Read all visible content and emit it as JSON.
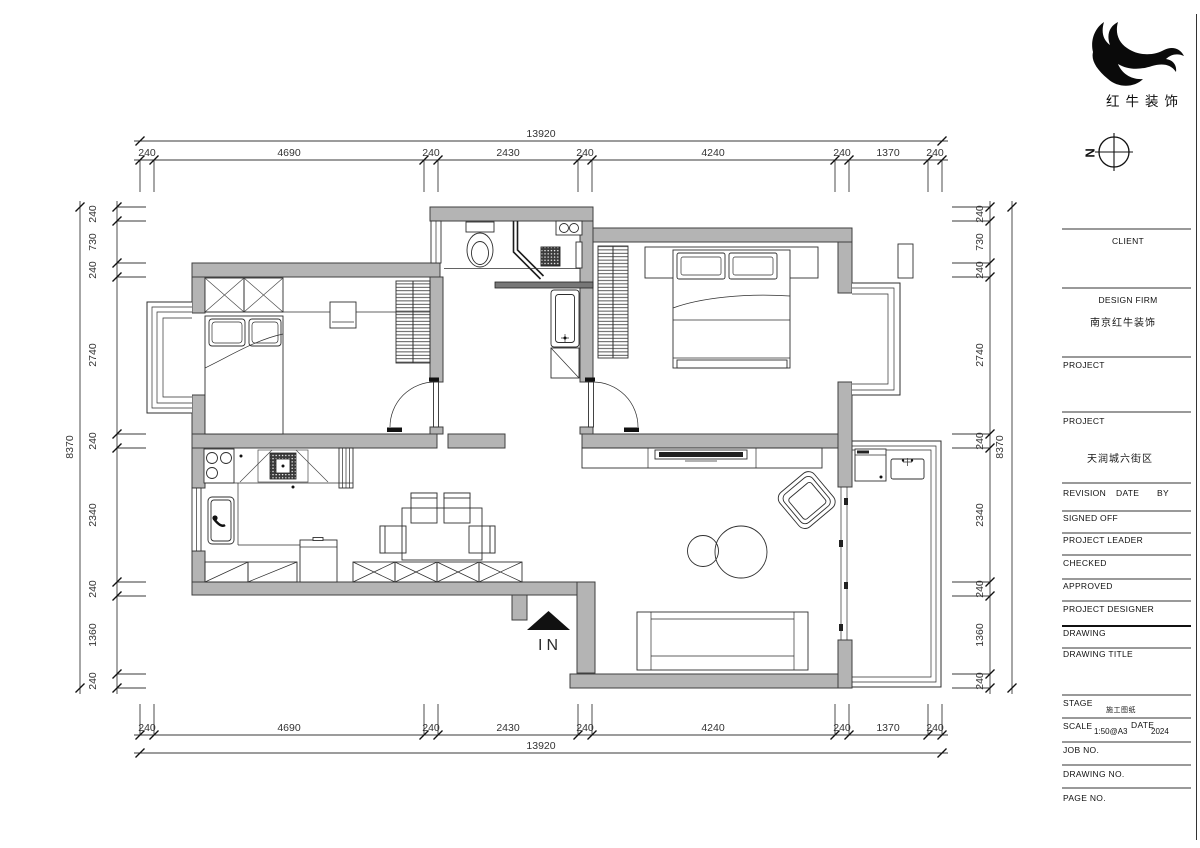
{
  "logo": {
    "brand": "红牛装饰"
  },
  "compass": {
    "label": "N"
  },
  "entrance": {
    "label": "IN"
  },
  "colors": {
    "wall_fill": "#b4b4b4",
    "line": "#2f2f2f",
    "logo": "#0a0a0a"
  },
  "dims": {
    "top": {
      "total": "13920",
      "segments": [
        "240",
        "4690",
        "240",
        "2430",
        "240",
        "4240",
        "240",
        "1370",
        "240"
      ]
    },
    "bottom": {
      "total": "13920",
      "segments": [
        "240",
        "4690",
        "240",
        "2430",
        "240",
        "4240",
        "240",
        "1370",
        "240"
      ]
    },
    "left": {
      "total": "8370",
      "segments": [
        "240",
        "730",
        "240",
        "2740",
        "240",
        "2340",
        "240",
        "1360",
        "240"
      ]
    },
    "right": {
      "total": "8370",
      "segments": [
        "240",
        "730",
        "240",
        "2740",
        "240",
        "2340",
        "240",
        "1360",
        "240"
      ]
    }
  },
  "titleblock": {
    "client_label": "CLIENT",
    "design_firm_label": "DESIGN FIRM",
    "design_firm_value": "南京红牛装饰",
    "project1_label": "PROJECT",
    "project2_label": "PROJECT",
    "project_value": "天润城六街区",
    "revision_label": "REVISION",
    "date_label": "DATE",
    "by_label": "BY",
    "signed_off_label": "SIGNED OFF",
    "project_leader_label": "PROJECT LEADER",
    "checked_label": "CHECKED",
    "approved_label": "APPROVED",
    "project_designer_label": "PROJECT DESIGNER",
    "drawing_label": "DRAWING",
    "drawing_title_label": "DRAWING TITLE",
    "stage_label": "STAGE",
    "stage_value": "施工图纸",
    "scale_label": "SCALE",
    "scale_value": "1:50@A3",
    "date2_label": "DATE",
    "date_value": "2024",
    "job_no_label": "JOB NO.",
    "drawing_no_label": "DRAWING NO.",
    "page_no_label": "PAGE NO."
  }
}
